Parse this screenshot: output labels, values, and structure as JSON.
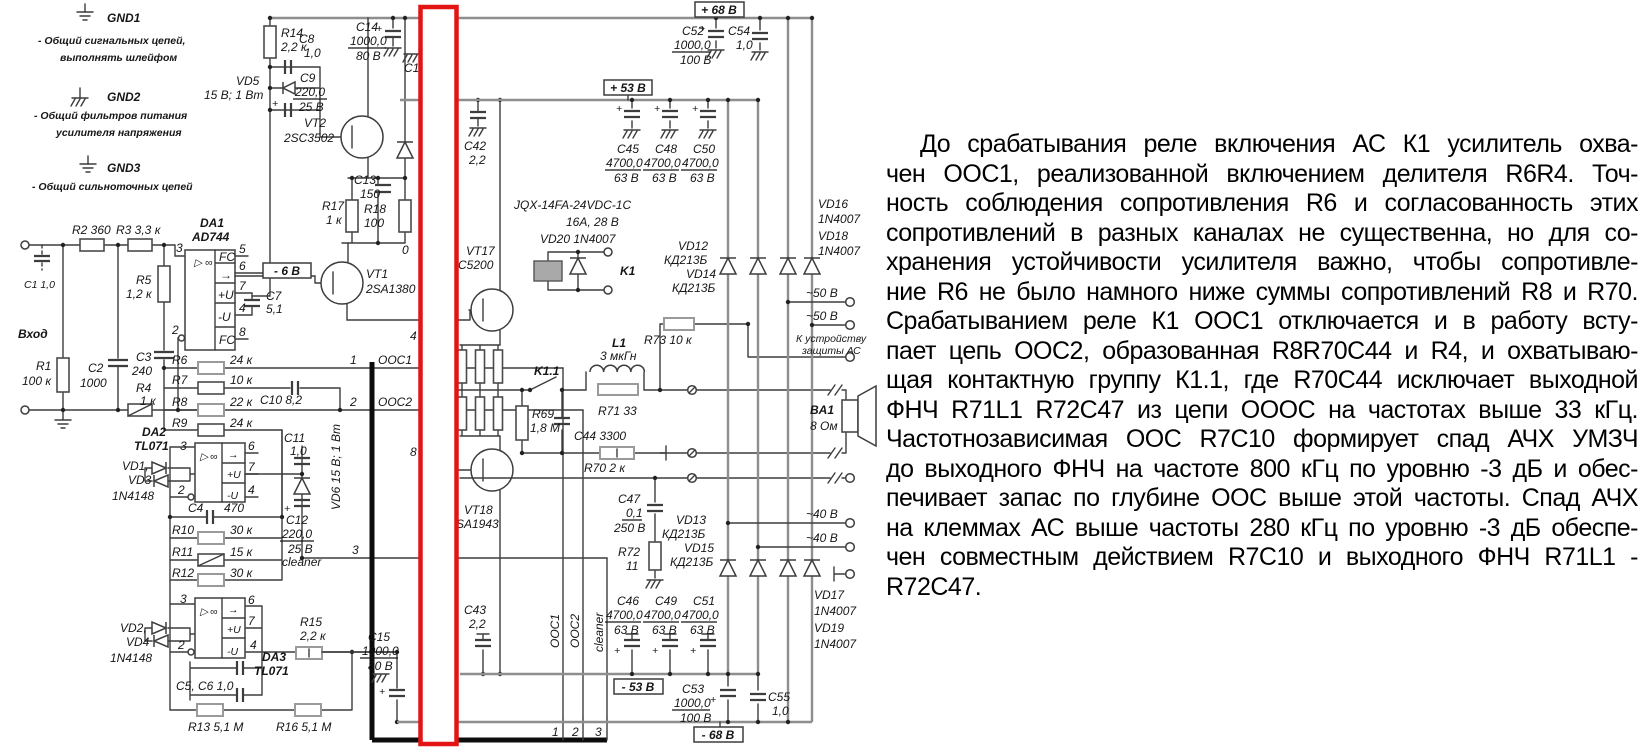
{
  "legend": {
    "g1": "GND1",
    "g1d1": "- Общий сигнальных цепей,",
    "g1d2": "выполнять шлейфом",
    "g2": "GND2",
    "g2d1": "- Общий фильтров питания",
    "g2d2": "усилителя напряжения",
    "g3": "GND3",
    "g3d1": "- Общий сильноточных цепей"
  },
  "volt": {
    "p68": "+ 68 В",
    "p53": "+ 53 В",
    "m6": "- 6 В",
    "m53": "- 53 В",
    "m68": "- 68 В",
    "ac50": "~50 В",
    "ac40": "~40 В"
  },
  "parts": {
    "input": "Вход",
    "c1": "C1 1,0",
    "r1": "R1",
    "r1v": "100 к",
    "c2": "C2",
    "c2v": "1000",
    "r2": "R2 360",
    "r3": "R3 3,3 к",
    "r5": "R5",
    "r5v": "1,2 к",
    "c3": "C3",
    "c3v": "240",
    "r4": "R4",
    "r4v": "1 к",
    "da1": "DA1",
    "da1t": "AD744",
    "da2": "DA2",
    "da2t": "TL071",
    "da3": "DA3",
    "da3t": "TL071",
    "r6": "R6",
    "v24k": "24 к",
    "r7": "R7",
    "r7v": "10 к",
    "r8": "R8",
    "r8v": "22 к",
    "r9": "R9",
    "c10": "C10  8,2",
    "c11": "C11",
    "v10": "1,0",
    "vd13a": "VD1,",
    "vd13b": "VD3",
    "n4148": "1N4148",
    "vd24a": "VD2,",
    "vd24b": "VD4",
    "c4": "C4",
    "c4v": "470",
    "r10": "R10",
    "v30k": "30 к",
    "r11": "R11",
    "r11v": "15 к",
    "r12": "R12",
    "c12": "C12",
    "v220": "220,0",
    "v25": "25 В",
    "cleaner": "cleaner",
    "c56": "C5, C6  1,0",
    "r13": "R13  5,1 М",
    "r16": "R16  5,1 М",
    "r15": "R15",
    "v2k2": "2,2 к",
    "vd6": "VD6  15 В; 1 Вт",
    "r14": "R14",
    "c8": "C8",
    "vd5": "VD5",
    "vd5v": "15 В; 1 Вт",
    "c9": "C9",
    "c14": "C14",
    "v1000": "1000,0",
    "v80": "80 В",
    "c17": "C17",
    "vt2": "VT2",
    "vt2t": "2SC3502",
    "c13": "C13",
    "c13v": "150",
    "r17": "R17",
    "r17v": "1 к",
    "r18": "R18",
    "r18v": "100",
    "vt1": "VT1",
    "vt1t": "2SA1380",
    "c7": "C7",
    "c7v": "5,1",
    "ooc1": "ООС1",
    "ooc2": "ООС2",
    "c15": "C15",
    "vt17": "VT17",
    "vt17t": "C5200",
    "vt18": "VT18",
    "vt18t": "SA1943",
    "frag0": "0",
    "frag4": "4",
    "frag8": "8",
    "c42": "C42",
    "v2_2": "2,2",
    "c43": "C43",
    "relay1": "JQX-14FA-24VDC-1C",
    "relay2": "16А, 28 В",
    "vd20": "VD20  1N4007",
    "k1": "K1",
    "k11": "K1.1",
    "l1": "L1",
    "l1v": "3 мкГн",
    "r71": "R71 33",
    "r73": "R73 10 к",
    "r69": "R69",
    "r69v": "1,8 М",
    "c44": "C44 3300",
    "r70": "R70  2 к",
    "c45": "C45",
    "c48": "C48",
    "c50": "C50",
    "v4700": "4700,0",
    "v63": "63 В",
    "c46": "C46",
    "c49": "C49",
    "c51": "C51",
    "c47": "C47",
    "c47v": "0,1",
    "v250": "250 В",
    "r72": "R72",
    "r72v": "11",
    "vd12": "VD12",
    "kd213": "КД213Б",
    "vd14": "VD14",
    "vd13": "VD13",
    "vd15": "VD15",
    "vd16": "VD16",
    "n4007": "1N4007",
    "vd18": "VD18",
    "vd17": "VD17",
    "vd19": "VD19",
    "prot1": "К устройству",
    "prot2": "защиты АС",
    "ba1": "BA1",
    "ba1v": "8 Ом",
    "c52": "C52",
    "v100b": "100 В",
    "c54": "C54",
    "c53": "C53",
    "c55": "C55"
  },
  "opamp": {
    "tri": "▷",
    "inf": "∞",
    "fc": "FC",
    "out": "→",
    "pu": "+U",
    "mu": "-U",
    "p2": "2",
    "p3": "3",
    "p4": "4",
    "p5": "5",
    "p6": "6",
    "p7": "7",
    "p8": "8"
  },
  "pins": {
    "p1": "1",
    "p2": "2",
    "p3": "3"
  },
  "article": {
    "lines": [
      "До срабатывания реле включения АС К1 усилитель охва-",
      "чен ООС1, реализованной включением делителя R6R4. Точ-",
      "ность соблюдения сопротивления R6 и согласованность этих",
      "сопротивлений в разных каналах не существенна, но для со-",
      "хранения устойчивости усилителя важно, чтобы сопротивле-",
      "ние R6 не было намного ниже суммы сопротивлений R8 и R70.",
      "Срабатыванием реле К1 ООС1 отключается и в работу всту-",
      "пает цепь ООС2, образованная R8R70C44 и R4, и охватываю-",
      "щая контактную группу К1.1, где R70C44 исключает выходной",
      "ФНЧ R71L1 R72C47 из цепи ОООС на частотах выше 33 кГц.",
      "Частотнозависимая ООС R7C10 формирует спад АЧХ УМЗЧ",
      "до выходного ФНЧ на частоте 800 кГц по уровню -3 дБ и обес-",
      "печивает запас по глубине ООС выше этой частоты. Спад АЧХ",
      "на клеммах АС выше частоты 280 кГц по уровню -3 дБ обеспе-",
      "чен совместным действием R7C10 и выходного ФНЧ R71L1 -",
      "R72C47."
    ]
  }
}
